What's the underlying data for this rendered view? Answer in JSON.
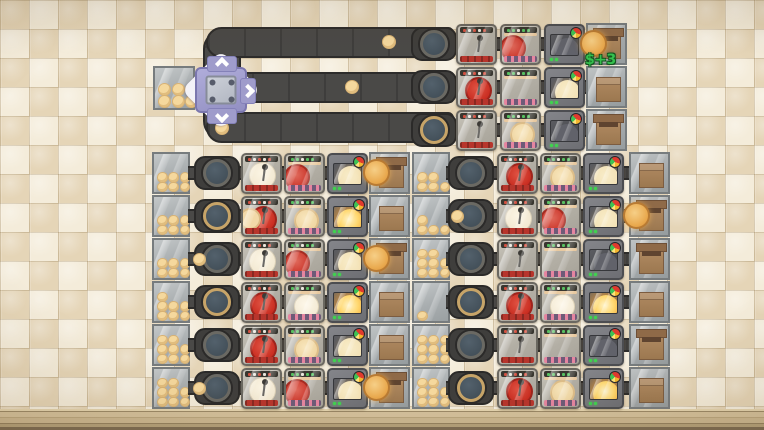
{
  "hud": {
    "money_popup": "$+3"
  },
  "palette": {
    "tile_light": "#f4ecda",
    "tile_dark": "#e5d5b7",
    "belt": "#4a4947",
    "belt_border": "#2d2c2b",
    "machine_glass": "#b3afa5",
    "burner_red": "#cf3327",
    "pan_bar_pink": "#e585a0",
    "oven_body": "#6d6e73",
    "glow_gold": "#ffd76e",
    "box_brown": "#a87f58",
    "dough": "#f5d89d",
    "splitter_purple": "#a19ecd",
    "money_green": "#35c04e",
    "floor_wood": "#cab690"
  },
  "top_section": {
    "supply_count": 6,
    "splitter_arrows": [
      "up",
      "right",
      "down"
    ],
    "belt_balls": [
      [
        389,
        42
      ],
      [
        352,
        87
      ],
      [
        222,
        128
      ]
    ],
    "rows": [
      {
        "node": "plain",
        "burner": "stick",
        "pan": "red-half",
        "oven": "dim",
        "box": "open-pancake"
      },
      {
        "node": "plain",
        "burner": "red",
        "pan": "empty",
        "oven": "pale",
        "box": "closed"
      },
      {
        "node": "gold",
        "burner": "stick",
        "pan": "pancake",
        "oven": "dim",
        "box": "open"
      }
    ]
  },
  "left_block": {
    "supplies": [
      6,
      6,
      6,
      7,
      8,
      8
    ],
    "rows": [
      {
        "node": "plain",
        "burner": "pale",
        "pan": "red-half",
        "oven": "pale",
        "box": "open-pancake",
        "entry_ball": false
      },
      {
        "node": "gold",
        "burner": "red-pancake",
        "pan": "pancake",
        "oven": "glow",
        "box": "closed",
        "entry_ball": false
      },
      {
        "node": "plain",
        "burner": "pale",
        "pan": "red-half",
        "oven": "pale",
        "box": "open-pancake",
        "entry_ball": true
      },
      {
        "node": "gold",
        "burner": "red",
        "pan": "pale",
        "oven": "glow",
        "box": "closed",
        "entry_ball": false
      },
      {
        "node": "plain",
        "burner": "red",
        "pan": "pancake",
        "oven": "pale",
        "box": "closed",
        "entry_ball": false
      },
      {
        "node": "plain",
        "burner": "pale",
        "pan": "red-half",
        "oven": "pale",
        "box": "open-pancake",
        "entry_ball": true
      }
    ]
  },
  "right_block": {
    "supplies": [
      5,
      4,
      8,
      1,
      9,
      8
    ],
    "rows": [
      {
        "node": "plain",
        "burner": "red",
        "pan": "pancake",
        "oven": "pale",
        "box": "closed",
        "entry_ball": false
      },
      {
        "node": "plain",
        "burner": "pale",
        "pan": "red-half",
        "oven": "pale",
        "box": "open-pancake",
        "entry_ball": true
      },
      {
        "node": "plain",
        "burner": "stick",
        "pan": "empty",
        "oven": "dim",
        "box": "open",
        "entry_ball": false
      },
      {
        "node": "gold",
        "burner": "red",
        "pan": "pale",
        "oven": "glow",
        "box": "closed",
        "entry_ball": false
      },
      {
        "node": "plain",
        "burner": "stick",
        "pan": "empty",
        "oven": "dim",
        "box": "open",
        "entry_ball": false
      },
      {
        "node": "gold",
        "burner": "red",
        "pan": "pancake",
        "oven": "glow",
        "box": "closed",
        "entry_ball": false
      }
    ]
  }
}
